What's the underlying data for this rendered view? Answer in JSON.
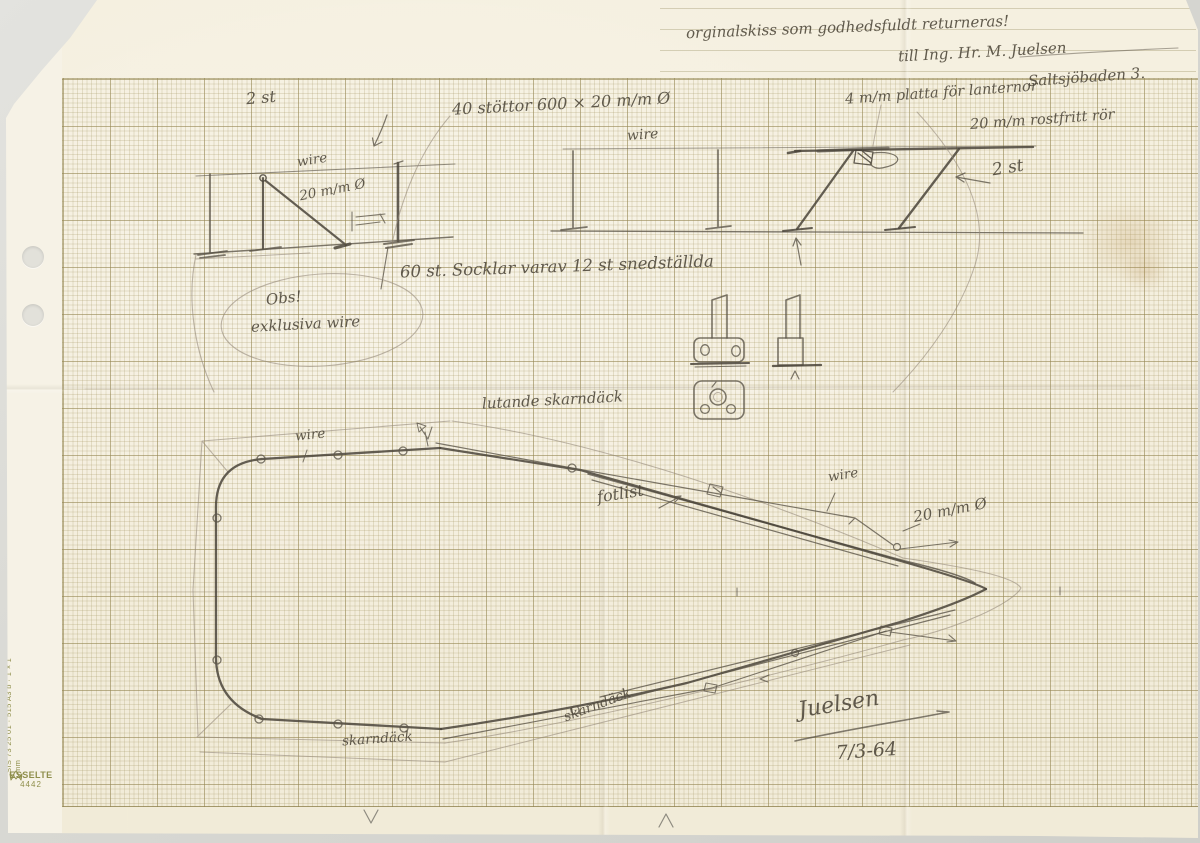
{
  "note": {
    "line1": "orginalskiss som godhedsfuldt returneras!",
    "line2": "till Ing. Hr. M. Juelsen",
    "line3": "Saltsjöbaden 3."
  },
  "labels": {
    "qty_left": "2 st",
    "stanchions": "40 stöttor 600 × 20 m/m Ø",
    "wire_left_elev": "wire",
    "tube_dia_left": "20 m/m Ø",
    "sockets": "60 st. Socklar varav 12 st snedställda",
    "obs_title": "Obs!",
    "obs_text": "exklusiva wire",
    "wire_right_elev": "wire",
    "lantern_plate": "4 m/m platta för lanternor",
    "stainless_tube": "20 m/m rostfritt rör",
    "qty_right": "2 st",
    "sloping_deck": "lutande skarndäck",
    "wire_plan_stern": "wire",
    "wire_plan_bow": "wire",
    "toe_rail": "fotlist",
    "tube_dia_plan": "20 m/m Ø",
    "deck_edge_stern": "skarndäck",
    "deck_edge_bow": "skarndäck"
  },
  "signature": {
    "name": "Juelsen",
    "date": "7/3-64"
  },
  "stationery": {
    "sis_spec": "SIS 73 25 01 · 515 A3 b · 1×1 mm",
    "brand": "ESSELTE",
    "product_no": "4442"
  }
}
